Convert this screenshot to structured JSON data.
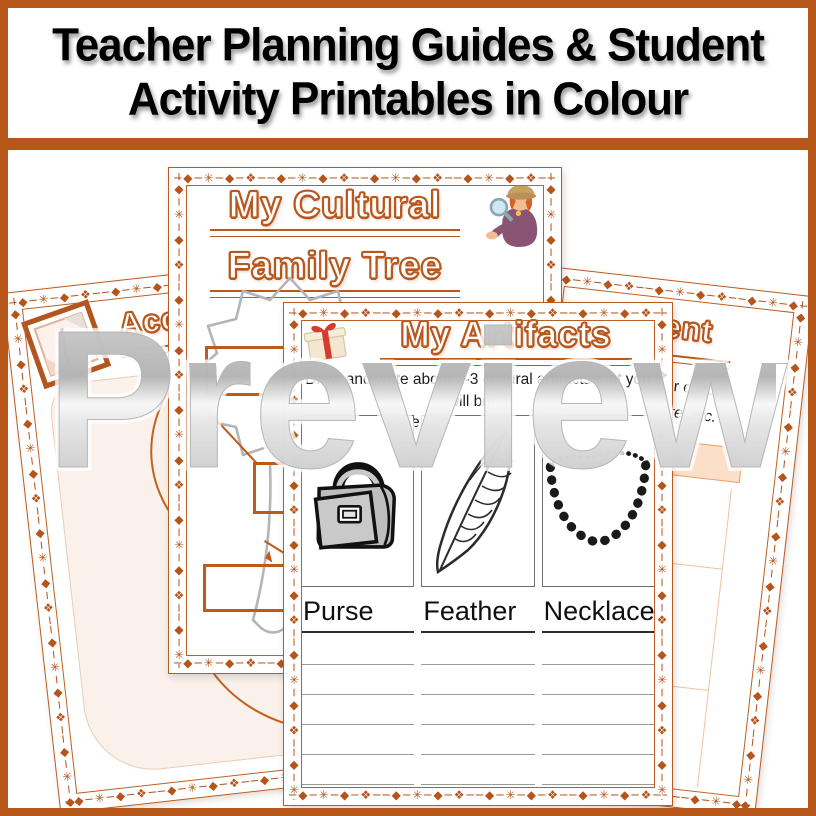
{
  "banner": {
    "line1": "Teacher Planning Guides & Student",
    "line2": "Activity Printables in Colour"
  },
  "watermark": {
    "text": "Preview"
  },
  "colors": {
    "frame": "#b65619",
    "ornament": "#b5541b",
    "title_outline": "#b9571d",
    "tree_gray": "#b5b5b5",
    "cream": "#faf1ea",
    "audience_bar_bg": "#fcdfc8",
    "audience_bar_border": "#ef9f63",
    "writing_line_gray": "#9a9a9a"
  },
  "decor": {
    "border_pattern": "─◆─✳─◆─❖"
  },
  "pages": {
    "accomplishments": {
      "icon": "notepad-pen-icon",
      "title_fragment": "Acc",
      "text_fragments": [
        "L",
        "ic"
      ]
    },
    "family_tree": {
      "icon": "detective-magnifier-icon",
      "title_line1": "My Cultural",
      "title_line2": "Family Tree"
    },
    "artifacts": {
      "icon": "gift-icon",
      "title": "My Artifacts",
      "instructions_line1": "Draw and write about 2-3 cultural artifacts that you will bring",
      "instructions_line2": "to share more about your culture.",
      "items": [
        {
          "label": "Purse",
          "image": "purse-drawing"
        },
        {
          "label": "Feather",
          "image": "feather-drawing"
        },
        {
          "label": "Necklace",
          "image": "necklace-drawing"
        }
      ],
      "writing_lines_per_column": 6
    },
    "involvement": {
      "title_fragment": "volvement",
      "text_line1": "ng about your culture",
      "text_line2": "ems to share, etc.",
      "bar_label": "The Audience"
    }
  }
}
